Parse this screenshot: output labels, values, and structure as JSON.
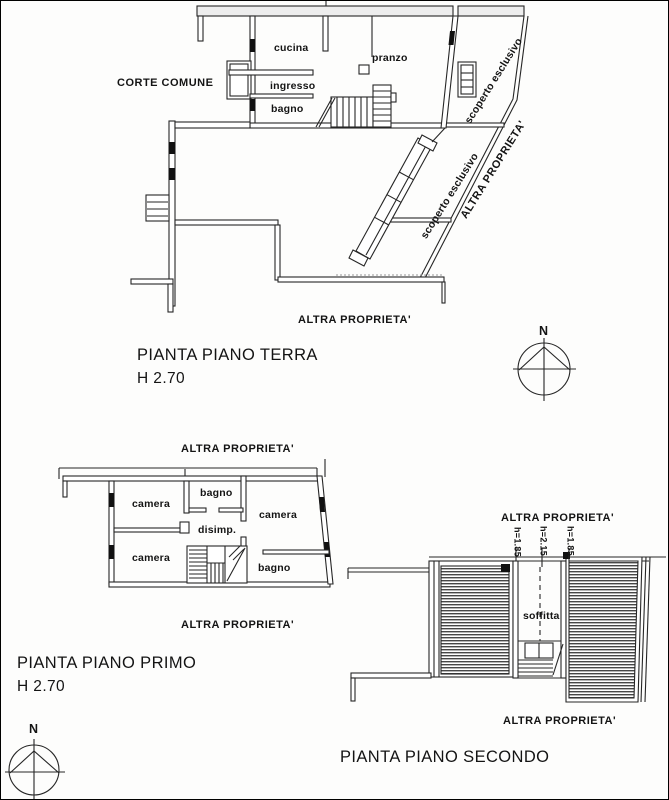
{
  "ground_floor": {
    "area_label": "CORTE COMUNE",
    "rooms": {
      "cucina": "cucina",
      "pranzo": "pranzo",
      "ingresso": "ingresso",
      "bagno": "bagno"
    },
    "scoperto_1": "scoperto esclusivo",
    "scoperto_2": "scoperto esclusivo",
    "altra_diagonal": "ALTRA PROPRIETA'",
    "altra_bottom": "ALTRA PROPRIETA'",
    "title": "PIANTA PIANO TERRA",
    "height_note": "H 2.70",
    "compass_label": "N"
  },
  "first_floor": {
    "altra_top": "ALTRA PROPRIETA'",
    "rooms": {
      "camera_top_left": "camera",
      "bagno_top": "bagno",
      "camera_right": "camera",
      "disimpegno": "disimp.",
      "camera_bottom_left": "camera",
      "bagno_bottom": "bagno"
    },
    "altra_bottom": "ALTRA PROPRIETA'",
    "title": "PIANTA PIANO PRIMO",
    "height_note": "H 2.70",
    "compass_label": "N"
  },
  "second_floor": {
    "altra_top": "ALTRA PROPRIETA'",
    "height_marks": [
      "h=1.85",
      "h=2.15",
      "h=1.85"
    ],
    "room": "soffitta",
    "altra_bottom": "ALTRA PROPRIETA'",
    "title": "PIANTA PIANO SECONDO"
  }
}
